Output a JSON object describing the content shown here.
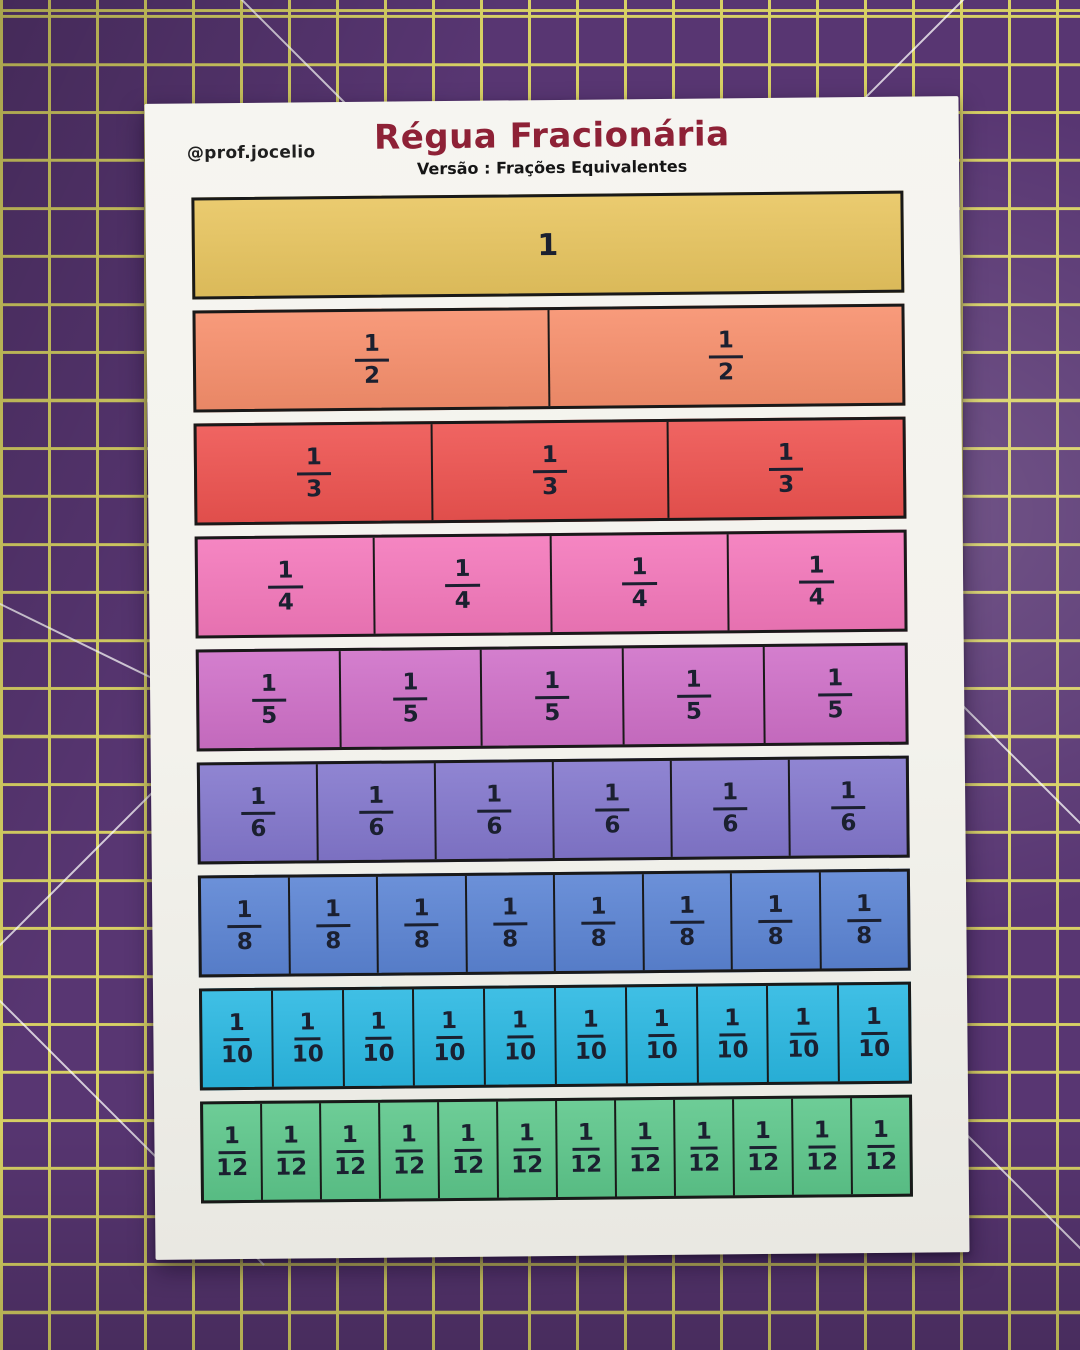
{
  "header": {
    "handle": "@prof.jocelio",
    "title": "Régua Fracionária",
    "subtitle": "Versão : Frações Equivalentes"
  },
  "colors": {
    "mat_purple": "#583672",
    "mat_grid_yellow": "#d8d164",
    "paper_white": "#f3f2ec",
    "title_maroon": "#8e2136",
    "fraction_ink": "#1b2030"
  },
  "fraction_rows": [
    {
      "numerator": "1",
      "denominator": "",
      "segments": 1,
      "color": "#e8c55f"
    },
    {
      "numerator": "1",
      "denominator": "2",
      "segments": 2,
      "color": "#f78f6c"
    },
    {
      "numerator": "1",
      "denominator": "3",
      "segments": 3,
      "color": "#ee5350"
    },
    {
      "numerator": "1",
      "denominator": "4",
      "segments": 4,
      "color": "#f478bb"
    },
    {
      "numerator": "1",
      "denominator": "5",
      "segments": 5,
      "color": "#cf70c8"
    },
    {
      "numerator": "1",
      "denominator": "6",
      "segments": 6,
      "color": "#8377cd"
    },
    {
      "numerator": "1",
      "denominator": "8",
      "segments": 8,
      "color": "#5b84d4"
    },
    {
      "numerator": "1",
      "denominator": "10",
      "segments": 10,
      "color": "#2ab8e2"
    },
    {
      "numerator": "1",
      "denominator": "12",
      "segments": 12,
      "color": "#5dc78b"
    }
  ]
}
